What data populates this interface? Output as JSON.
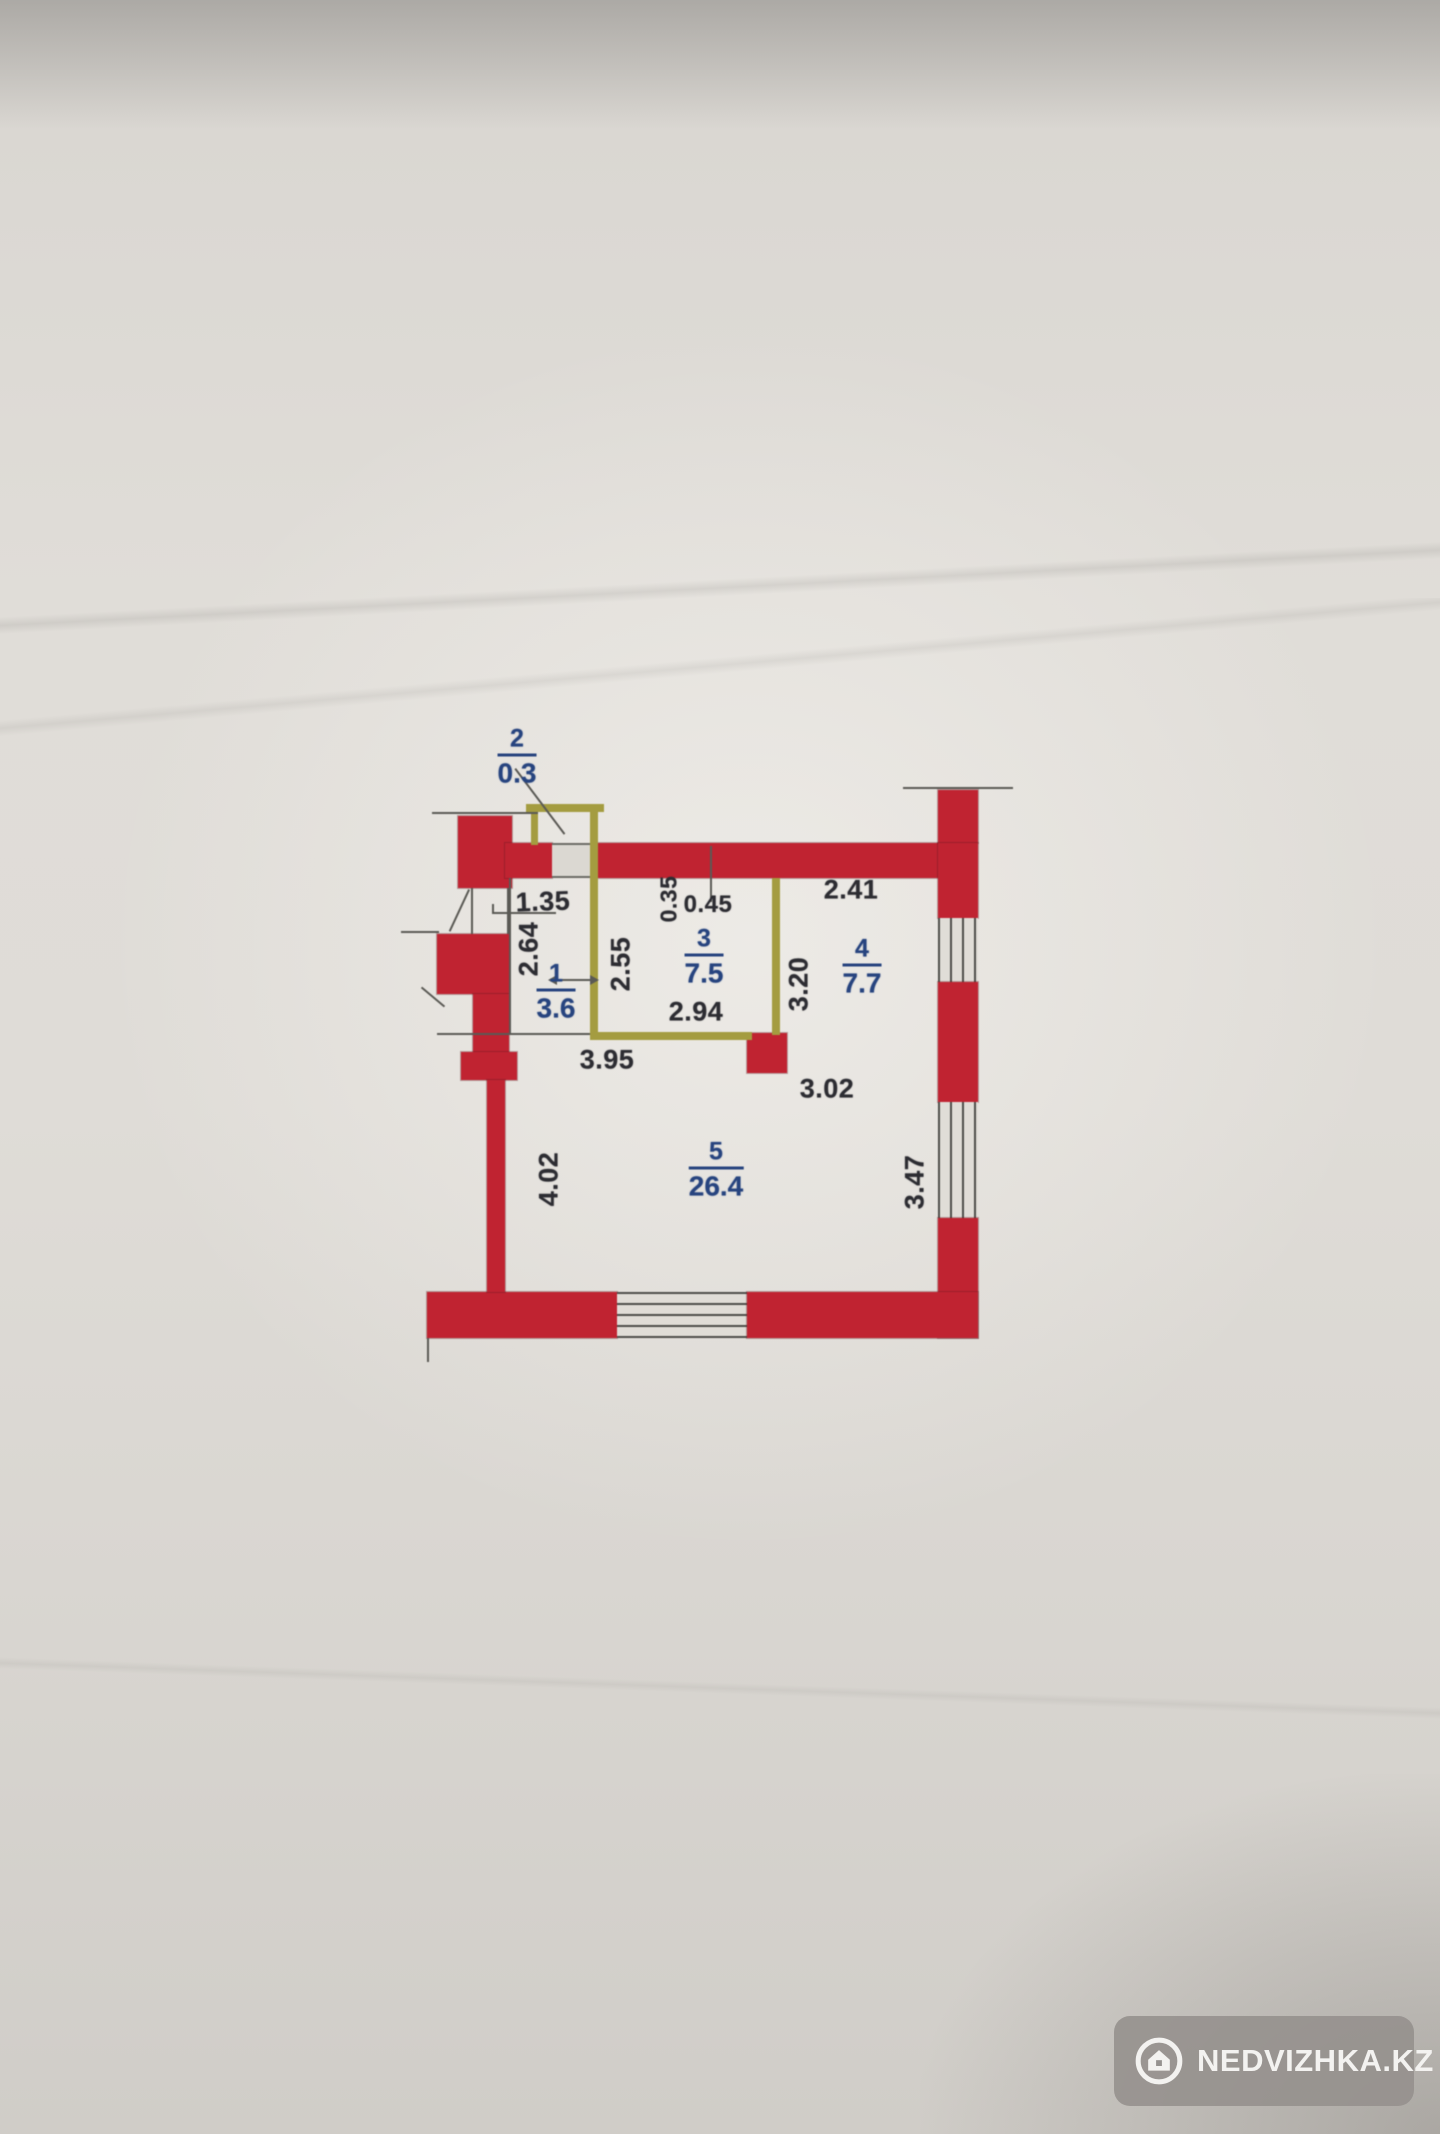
{
  "watermark": {
    "label": "NEDVIZHKA.KZ",
    "icon": "house-icon"
  },
  "rooms": {
    "r1": {
      "number": "1",
      "area": "3.6"
    },
    "r2": {
      "number": "2",
      "area": "0.3"
    },
    "r3": {
      "number": "3",
      "area": "7.5"
    },
    "r4": {
      "number": "4",
      "area": "7.7"
    },
    "r5": {
      "number": "5",
      "area": "26.4"
    }
  },
  "dimensions": {
    "balcony_width": "1.35",
    "hall_depth": "2.64",
    "room3_left": "2.55",
    "niche_depth": "0.35",
    "niche_width": "0.45",
    "room4_width": "2.41",
    "room3_width": "2.94",
    "room4_depth": "3.20",
    "hall_width": "3.95",
    "room5_inset": "3.02",
    "room5_left": "4.02",
    "room5_right": "3.47"
  },
  "colors": {
    "wall": "#c2202f",
    "partition": "#a59d3e",
    "room_label": "#24427f",
    "dimension": "#2a2a30",
    "line": "#5a5954"
  }
}
